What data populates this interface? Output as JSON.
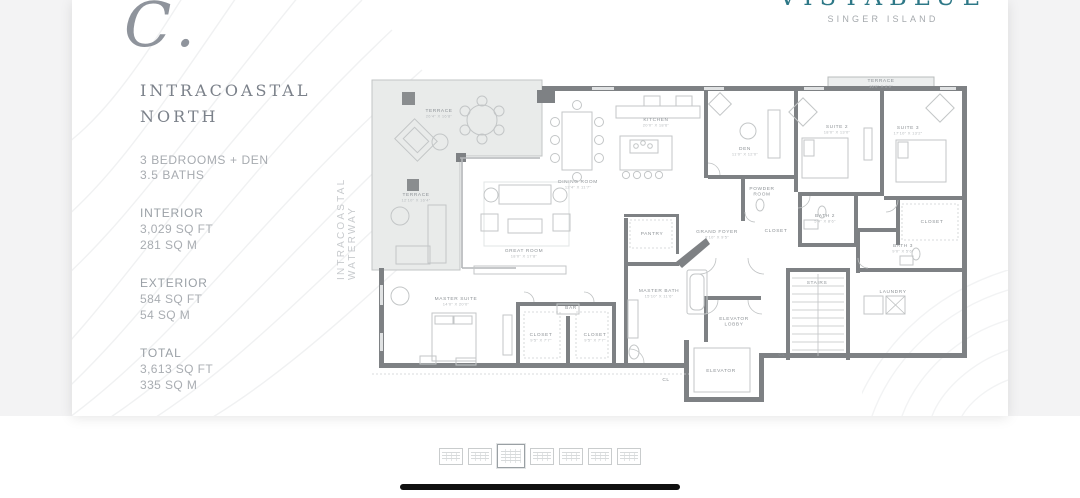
{
  "logo": {
    "name": "VISTABLUE",
    "tagline": "SINGER ISLAND",
    "brand_color": "#2e7887"
  },
  "plan_info": {
    "plan_letter": "C.",
    "plan_name_line1": "INTRACOASTAL",
    "plan_name_line2": "NORTH",
    "bedrooms": "3 BEDROOMS + DEN",
    "baths": "3.5 BATHS",
    "stats": [
      {
        "label": "INTERIOR",
        "lines": [
          "3,029 SQ FT",
          "281 SQ M"
        ]
      },
      {
        "label": "EXTERIOR",
        "lines": [
          "584 SQ FT",
          "54 SQ M"
        ]
      },
      {
        "label": "TOTAL",
        "lines": [
          "3,613 SQ FT",
          "335 SQ M"
        ]
      }
    ]
  },
  "floorplan": {
    "waterway_label": "INTRACOASTAL WATERWAY",
    "rooms": [
      {
        "name": "TERRACE",
        "dims": "26'4\" X 16'8\"",
        "x": 435,
        "y": 112
      },
      {
        "name": "TERRACE",
        "dims": "12'10\" X 16'4\"",
        "x": 412,
        "y": 196
      },
      {
        "name": "TERRACE",
        "dims": "16'0\" X 2'0\"",
        "x": 877,
        "y": 82
      },
      {
        "name": "KITCHEN",
        "dims": "20'0\" X 18'6\"",
        "x": 652,
        "y": 121
      },
      {
        "name": "DINING ROOM",
        "dims": "12'4\" X 11'7\"",
        "x": 574,
        "y": 183
      },
      {
        "name": "GREAT ROOM",
        "dims": "18'0\" X 17'8\"",
        "x": 520,
        "y": 252
      },
      {
        "name": "DEN",
        "dims": "11'0\" X 12'0\"",
        "x": 741,
        "y": 150
      },
      {
        "name": "SUITE 2",
        "dims": "18'0\" X 13'0\"",
        "x": 833,
        "y": 128
      },
      {
        "name": "SUITE 3",
        "dims": "17'10\" X 13'2\"",
        "x": 904,
        "y": 129
      },
      {
        "name": "POWDER\nROOM",
        "dims": "",
        "x": 758,
        "y": 190
      },
      {
        "name": "BATH 2",
        "dims": "5'4\" X 8'6\"",
        "x": 821,
        "y": 217
      },
      {
        "name": "BATH 3",
        "dims": "9'0\" X 5'6\"",
        "x": 899,
        "y": 247
      },
      {
        "name": "CLOSET",
        "dims": "",
        "x": 928,
        "y": 223
      },
      {
        "name": "LAUNDRY",
        "dims": "",
        "x": 889,
        "y": 293
      },
      {
        "name": "STAIRS",
        "dims": "",
        "x": 813,
        "y": 284
      },
      {
        "name": "GRAND FOYER",
        "dims": "9'10\" X 9'5\"",
        "x": 713,
        "y": 233
      },
      {
        "name": "PANTRY",
        "dims": "",
        "x": 648,
        "y": 235
      },
      {
        "name": "CLOSET",
        "dims": "",
        "x": 772,
        "y": 232
      },
      {
        "name": "MASTER BATH",
        "dims": "15'10\" X 11'6\"",
        "x": 655,
        "y": 292
      },
      {
        "name": "MASTER SUITE",
        "dims": "14'0\" X 20'0\"",
        "x": 452,
        "y": 300
      },
      {
        "name": "CLOSET",
        "dims": "9'5\" X 7'7\"",
        "x": 537,
        "y": 336
      },
      {
        "name": "CLOSET",
        "dims": "9'5\" X 7'7\"",
        "x": 591,
        "y": 336
      },
      {
        "name": "BAR",
        "dims": "",
        "x": 567,
        "y": 309
      },
      {
        "name": "ELEVATOR\nLOBBY",
        "dims": "",
        "x": 730,
        "y": 320
      },
      {
        "name": "ELEVATOR",
        "dims": "",
        "x": 717,
        "y": 372
      },
      {
        "name": "CL",
        "dims": "",
        "x": 662,
        "y": 381
      },
      {
        "name": "CL",
        "dims": "",
        "x": 778,
        "y": 356
      }
    ]
  },
  "thumbnails": {
    "selected_index": 2,
    "items": [
      {
        "label": "Floor plan thumbnail 1",
        "selected": false
      },
      {
        "label": "Floor plan thumbnail 2",
        "selected": false
      },
      {
        "label": "Floor plan thumbnail 3",
        "selected": true
      },
      {
        "label": "Floor plan thumbnail 4",
        "selected": false
      },
      {
        "label": "Floor plan thumbnail 5",
        "selected": false
      },
      {
        "label": "Floor plan thumbnail 6",
        "selected": false
      },
      {
        "label": "Floor plan thumbnail 7",
        "selected": false
      }
    ]
  }
}
